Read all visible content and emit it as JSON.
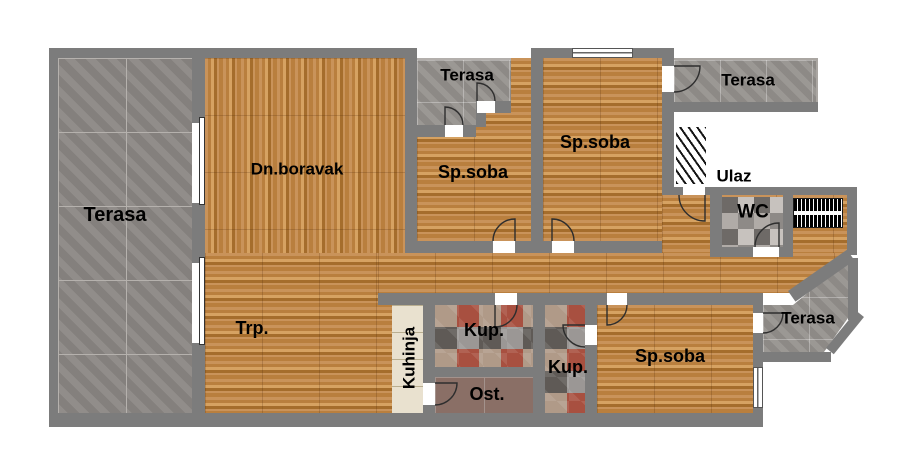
{
  "plan_title": "Apartment floor plan",
  "rooms": {
    "terasa_left": {
      "label": "Terasa"
    },
    "dn_boravak": {
      "label": "Dn.boravak"
    },
    "trp": {
      "label": "Trp."
    },
    "terasa_mid": {
      "label": "Terasa"
    },
    "sp_soba_mid": {
      "label": "Sp.soba"
    },
    "sp_soba_ne": {
      "label": "Sp.soba"
    },
    "terasa_ne": {
      "label": "Terasa"
    },
    "ulaz": {
      "label": "Ulaz"
    },
    "wc": {
      "label": "WC"
    },
    "kuhinja": {
      "label": "Kuhinja"
    },
    "kup_1": {
      "label": "Kup."
    },
    "ost": {
      "label": "Ost."
    },
    "kup_2": {
      "label": "Kup."
    },
    "sp_soba_se": {
      "label": "Sp.soba"
    },
    "terasa_se": {
      "label": "Terasa"
    }
  },
  "colors": {
    "bg": "#ffffff",
    "wall": "#7c7c7c",
    "label": "#000000",
    "wood1": "#c9935a",
    "wood2": "#b97f3e",
    "wood3": "#d6a262",
    "wood4": "#a56d2c",
    "tile": "#8b8784",
    "tile_grout": "#b5b1ad",
    "tile2": "#96928e",
    "kitchen": "#e9e1cf",
    "kitchen_seam": "#b9ae90",
    "ost": "#8a6f66",
    "ost_grout": "#a3928c",
    "m1": "#a85040",
    "m2": "#9b9795",
    "m3": "#5f5a56",
    "m4": "#b09a88",
    "wc1": "#c7c2be",
    "wc2": "#8e8a87",
    "wc3": "#b0aba7",
    "wc4": "#6e6a67"
  }
}
